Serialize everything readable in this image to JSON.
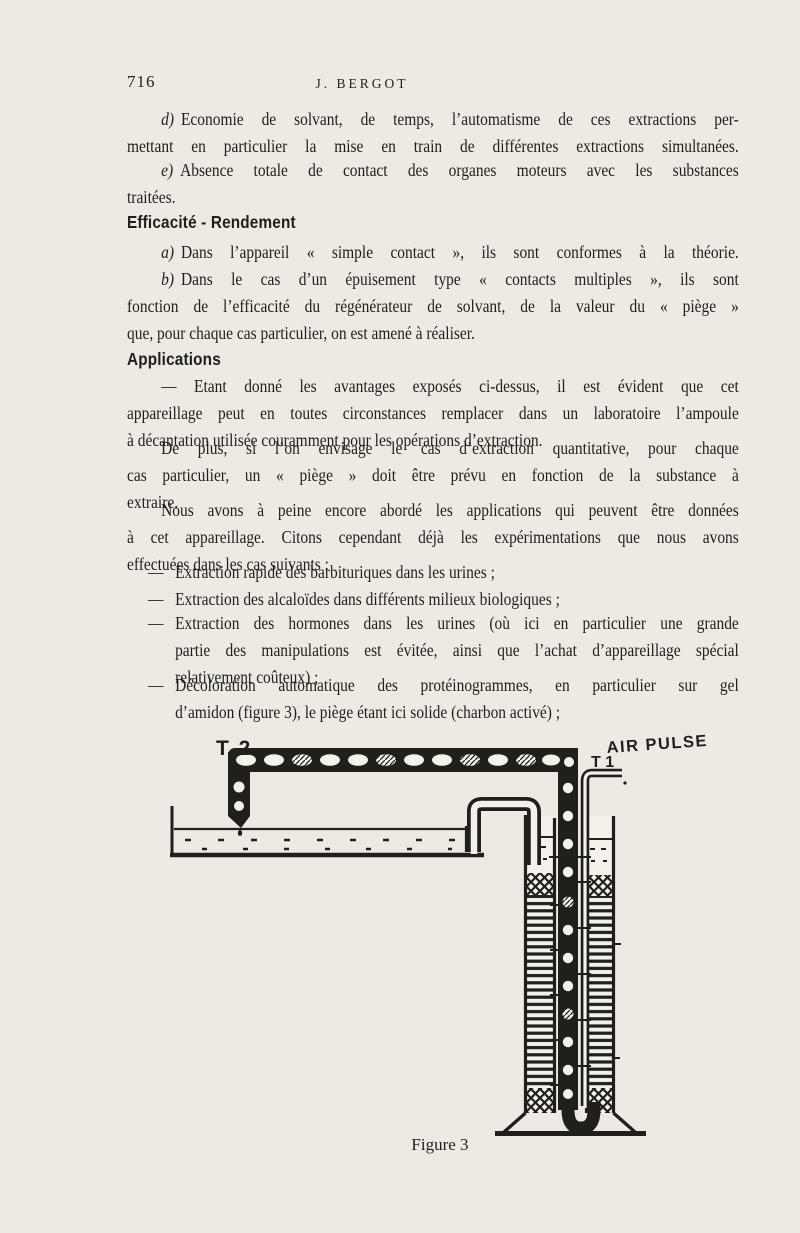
{
  "colors": {
    "paper": "#edeae3",
    "ink": "#201f1b"
  },
  "page": {
    "number": "716",
    "running_head": "J. BERGOT"
  },
  "headings": {
    "efficacite": "Efficacité - Rendement",
    "applications": "Applications"
  },
  "paragraphs": {
    "d": {
      "marker": "d)",
      "lines": [
        "Economie de solvant, de temps, l’automatisme de ces extractions per-",
        "mettant en particulier la mise en train de différentes extractions simultanées."
      ]
    },
    "e": {
      "marker": "e)",
      "lines": [
        "Absence totale de contact des organes moteurs avec les substances",
        "traitées."
      ]
    },
    "a": {
      "marker": "a)",
      "lines": [
        "Dans l’appareil « simple contact », ils sont conformes à la théorie."
      ]
    },
    "b": {
      "marker": "b)",
      "lines": [
        "Dans le cas d’un épuisement type « contacts multiples », ils sont",
        "fonction de l’efficacité du régénérateur de solvant, de la valeur du « piège »",
        "que, pour chaque cas particulier, on est amené à réaliser."
      ]
    },
    "etant": {
      "lines": [
        "— Etant donné les avantages exposés ci-dessus, il est évident que cet",
        "appareillage peut en toutes circonstances remplacer dans un laboratoire l’ampoule",
        "à décantation utilisée couramment pour les opérations d’extraction."
      ]
    },
    "deplus": {
      "lines": [
        "De plus, si l’on envisage le cas d’extraction quantitative, pour chaque",
        "cas particulier, un « piège » doit être prévu en fonction de la substance à",
        "extraire."
      ]
    },
    "nous": {
      "lines": [
        "Nous avons à peine encore abordé les applications qui peuvent être données",
        "à cet appareillage. Citons cependant déjà les expérimentations que nous avons",
        "effectuées dans les cas suivants :"
      ]
    }
  },
  "list_marker": "—",
  "list": [
    {
      "lines": [
        "Extraction rapide des barbituriques dans les urines ;"
      ]
    },
    {
      "lines": [
        "Extraction des alcaloïdes dans différents milieux biologiques ;"
      ]
    },
    {
      "lines": [
        "Extraction des hormones dans les urines (où ici en particulier une grande",
        "partie des manipulations est évitée, ainsi que l’achat d’appareillage spécial",
        "relativement coûteux) ;"
      ]
    },
    {
      "lines": [
        "Décoloration automatique des protéinogrammes, en particulier sur gel",
        "d’amidon (figure 3), le piège étant ici solide (charbon activé) ;"
      ]
    }
  ],
  "figure": {
    "label_t2": "T 2",
    "label_t1": "T 1",
    "label_air_pulse": "AIR PULSE",
    "caption": "Figure 3"
  }
}
